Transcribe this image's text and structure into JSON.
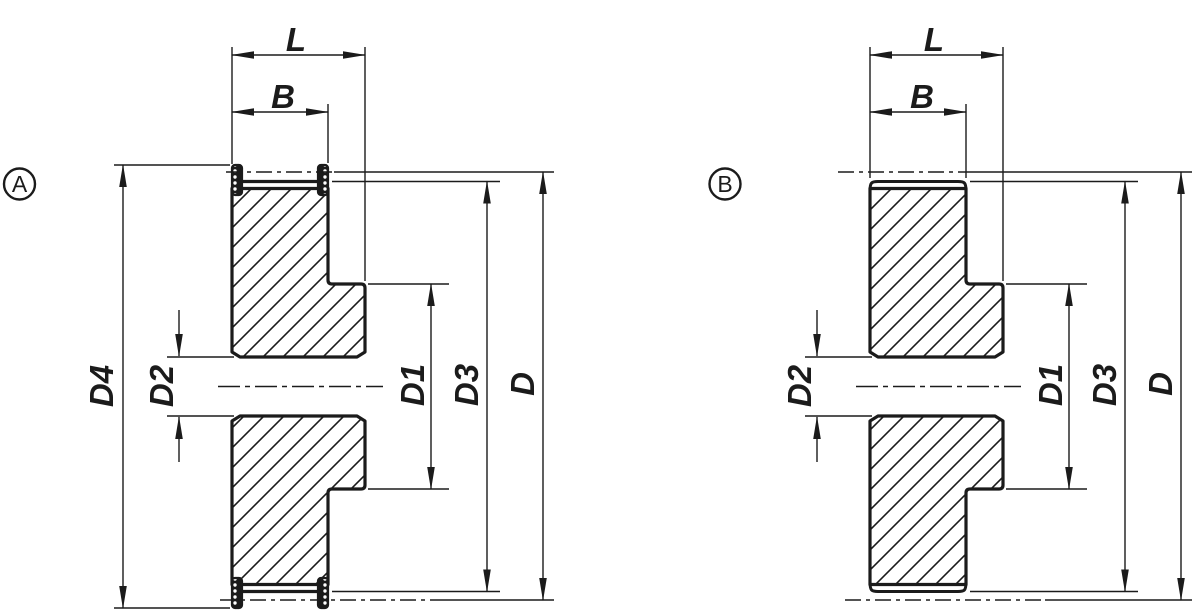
{
  "drawing": {
    "background": "#ffffff",
    "line_color": "#1b1b1b",
    "variants": [
      {
        "marker": "A",
        "labels": {
          "L": "L",
          "B": "B",
          "D4": "D4",
          "D2": "D2",
          "D1": "D1",
          "D3": "D3",
          "D": "D"
        }
      },
      {
        "marker": "B",
        "labels": {
          "L": "L",
          "B": "B",
          "D2": "D2",
          "D1": "D1",
          "D3": "D3",
          "D": "D"
        }
      }
    ]
  }
}
